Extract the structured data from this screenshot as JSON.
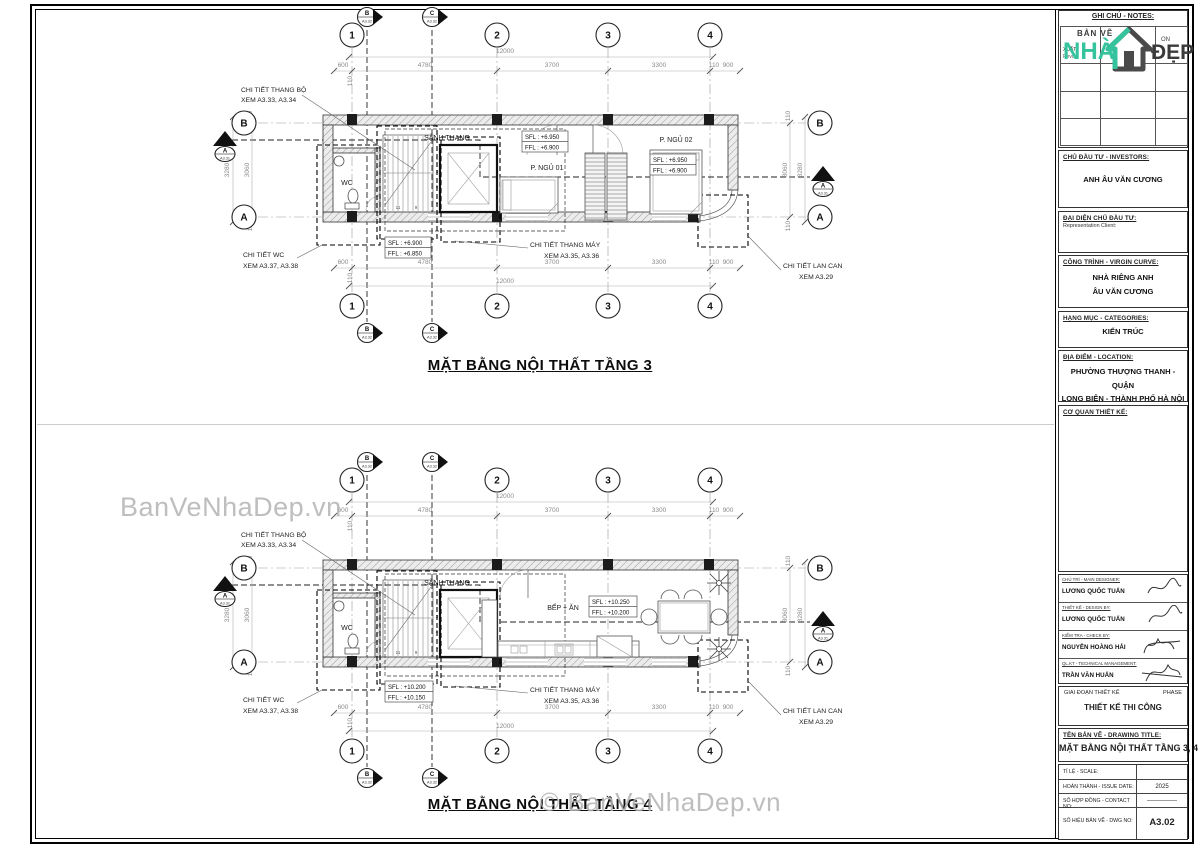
{
  "grid": {
    "c1": "1",
    "c2": "2",
    "c3": "3",
    "c4": "4",
    "rA": "A",
    "rB": "B",
    "sB": "B",
    "sC": "C",
    "secRef": "A3.32",
    "sA": "A",
    "saRef": "A3.31"
  },
  "dims": {
    "total": "12000",
    "d600": "600",
    "d110": "110",
    "d4780": "4780",
    "d3700": "3700",
    "d3300": "3300",
    "d900": "900",
    "v3280": "3280",
    "v3060": "3060"
  },
  "stairs": {
    "n1": "1",
    "n3": "3",
    "n5": "5",
    "n7": "7",
    "n9": "9",
    "n11": "11"
  },
  "rooms_common": {
    "wc": "WC",
    "hall": "SẢNH THANG"
  },
  "notes": {
    "stair1": "CHI TIẾT THANG BỘ",
    "stair2": "XEM A3.33, A3.34",
    "wc1": "CHI TIẾT WC",
    "wc2": "XEM A3.37, A3.38",
    "lift1": "CHI TIẾT THANG MÁY",
    "lift2": "XEM A3.35, A3.36",
    "rail1": "CHI TIẾT LAN CAN",
    "rail2": "XEM A3.29"
  },
  "plan1": {
    "title": "MẶT BẰNG  NỘI THẤT TẦNG 3",
    "rooms": {
      "bed1": "P. NGỦ 01",
      "bed2": "P. NGỦ 02"
    },
    "levels": {
      "a1": "SFL : +6.950",
      "a2": "FFL : +6.900",
      "b1": "SFL : +6.950",
      "b2": "FFL : +6.900",
      "c1": "SFL : +6.900",
      "c2": "FFL : +6.850"
    }
  },
  "plan2": {
    "title": "MẶT BẰNG NỘI THẤT TẦNG 4",
    "rooms": {
      "kitchen": "BẾP + ĂN"
    },
    "levels": {
      "b1": "SFL : +10.250",
      "b2": "FFL : +10.200",
      "c1": "SFL : +10.200",
      "c2": "FFL : +10.150"
    }
  },
  "watermarks": {
    "w1": "BanVeNhaDep.vn",
    "w2": "© BanVeNhaDep.vn"
  },
  "titleblock": {
    "notes_header": "GHI CHÚ - NOTES:",
    "logo": {
      "line1": "BẢN VẼ",
      "line2": "NHÀ",
      "line3": "ĐẸP"
    },
    "revision": {
      "col1": "XUẤT",
      "col1b": "Revi:",
      "col3": "ON"
    },
    "investor_label": "CHỦ ĐẦU TƯ - INVESTORS:",
    "investor": "ANH ÂU VĂN CƯƠNG",
    "rep_label": "ĐẠI DIỆN CHỦ ĐẦU TƯ:",
    "rep_sub": "Representation Client:",
    "project_label": "CÔNG TRÌNH - VIRGIN CURVE:",
    "project1": "NHÀ RIÊNG ANH",
    "project2": "ÂU VĂN CƯƠNG",
    "category_label": "HẠNG MỤC - CATEGORIES:",
    "category": "KIẾN TRÚC",
    "location_label": "ĐỊA ĐIỂM - LOCATION:",
    "location1": "PHƯỜNG THƯỢNG THANH - QUẬN",
    "location2": "LONG BIÊN - THÀNH PHỐ HÀ NỘI",
    "agency_label": "CƠ QUAN THIẾT KẾ:",
    "signatures": [
      {
        "label": "CHỦ TRÌ - MAIN DESIGNER:",
        "name": "LƯƠNG QUỐC TUẤN"
      },
      {
        "label": "THIẾT KẾ - DESIGN BY:",
        "name": "LƯƠNG QUỐC TUẤN"
      },
      {
        "label": "KIỂM TRA - CHECK BY:",
        "name": "NGUYỄN HOÀNG HẢI"
      },
      {
        "label": "QL.KT - TECHNICAL MANAGEMENT:",
        "name": "TRẦN VĂN HUẤN"
      }
    ],
    "phase_label": "GIAI ĐOẠN THIẾT KẾ",
    "phase_en": "PHASE",
    "phase_value": "THIẾT KẾ THI CÔNG",
    "title_label": "TÊN BẢN VẼ - DRAWING TITLE:",
    "drawing_title": "MẶT BẰNG NỘI THẤT TẦNG 3, 4",
    "scale_label": "TỈ LỆ - SCALE:",
    "scale_value": "",
    "date_label": "HOÀN THÀNH - ISSUE DATE:",
    "date_value": "2025",
    "contract_label": "SỐ HỢP ĐỒNG - CONTACT NO:",
    "contract_value": "—————",
    "dwg_label": "SỐ HIỆU BẢN VẼ - DWG NO:",
    "dwg_value": "A3.02",
    "accent": "#35c39d"
  }
}
